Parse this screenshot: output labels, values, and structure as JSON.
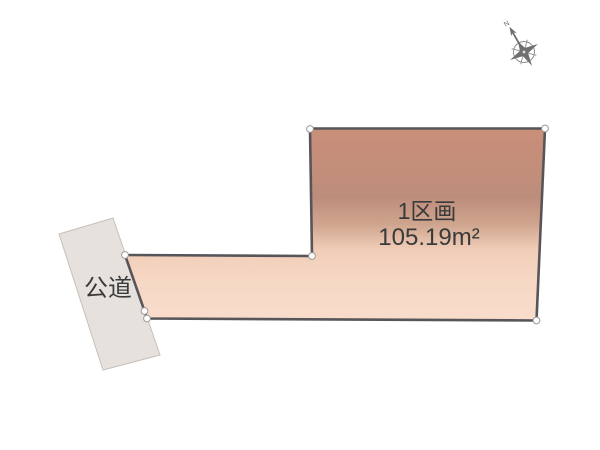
{
  "plot": {
    "label": "1区画",
    "area": "105.19m²"
  },
  "road": {
    "label": "公道"
  },
  "compass": {
    "north_label": "N"
  },
  "colors": {
    "plot_border": "#57555a",
    "plot_gradient": [
      "#c98f79",
      "#bd8d7b",
      "#cfa58e",
      "#f0cdb8",
      "#f6d7c4",
      "#f8dccb"
    ],
    "road_fill": "#e6e1dc",
    "road_border": "#c6c0ba",
    "vertex_fill": "#ffffff",
    "text": "#3a3a3a",
    "compass": "#8f8f8f"
  }
}
